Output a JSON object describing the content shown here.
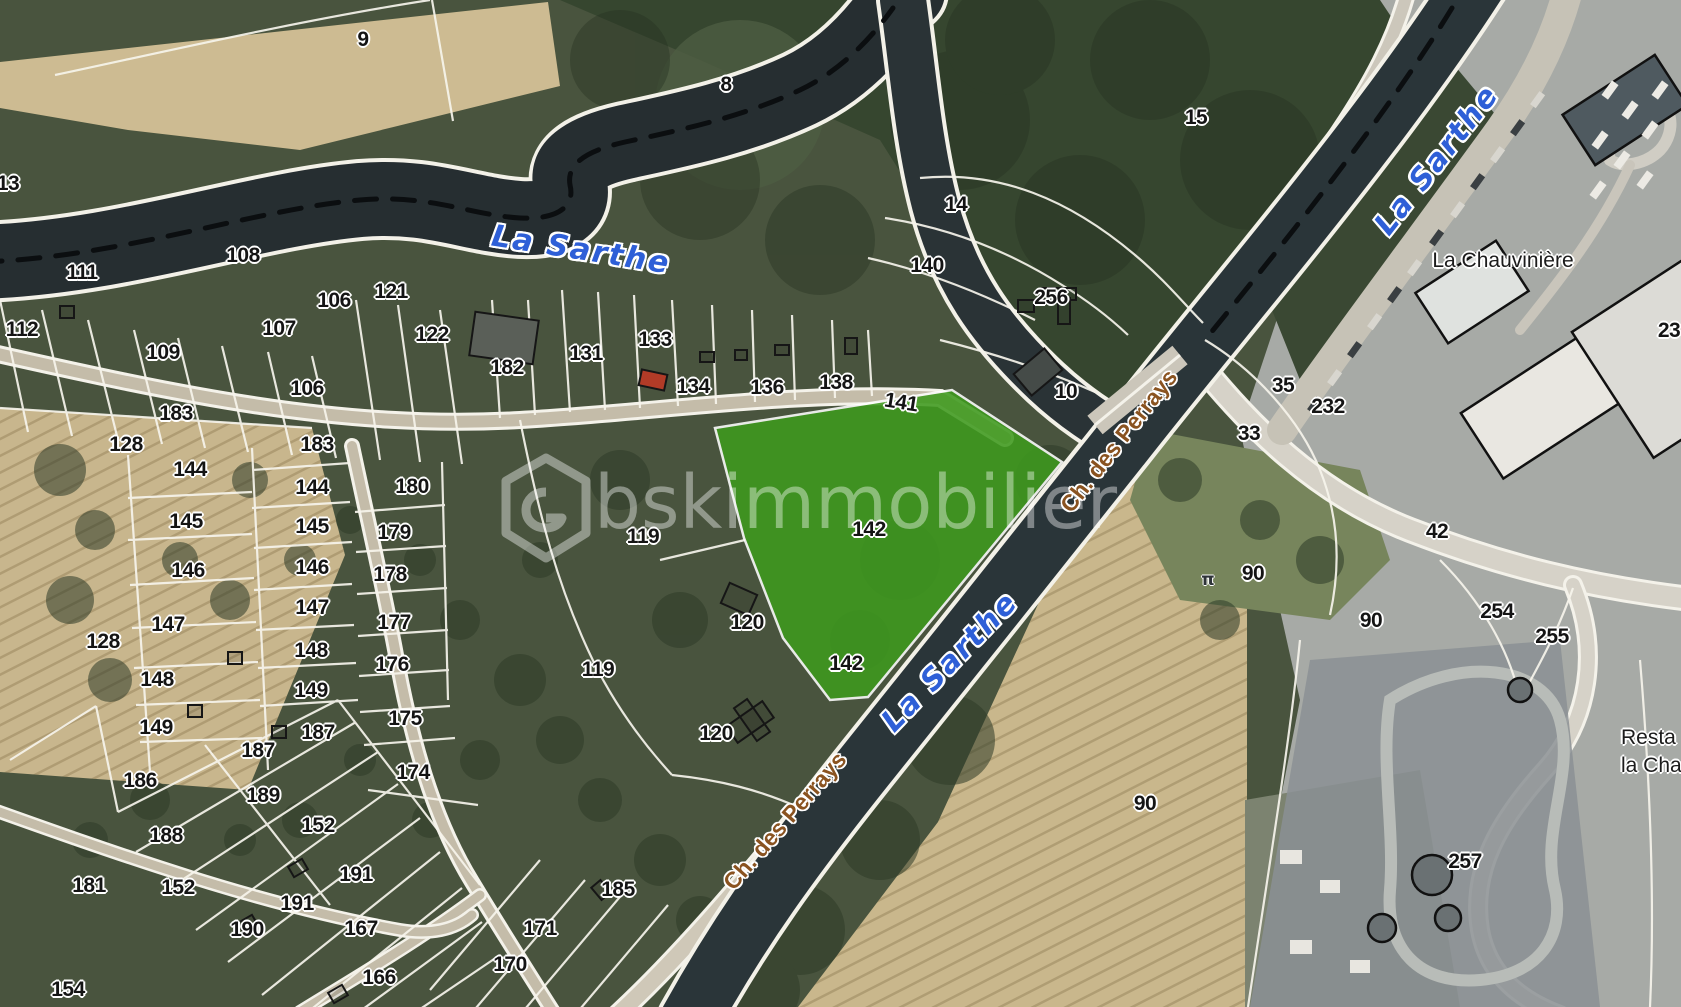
{
  "map": {
    "type": "satellite-cadastral-map",
    "colors": {
      "highlight_green": "#3e9a1e",
      "water_dark": "#262e31",
      "boundary_white": "#f8f6f0",
      "label_black": "#141414",
      "water_label_blue": "#2e5fd7",
      "road_label_brown": "#8a5320",
      "watermark": "rgba(255,255,255,0.40)"
    },
    "watermark": {
      "text": "bskimmobilier",
      "logo": "hexagon-logo"
    },
    "highlighted_parcel": "142",
    "parcel_labels": [
      {
        "t": "9",
        "x": 363,
        "y": 40
      },
      {
        "t": "8",
        "x": 726,
        "y": 85
      },
      {
        "t": "15",
        "x": 1196,
        "y": 118
      },
      {
        "t": "13",
        "x": 8,
        "y": 184
      },
      {
        "t": "14",
        "x": 956,
        "y": 205
      },
      {
        "t": "108",
        "x": 243,
        "y": 256
      },
      {
        "t": "111",
        "x": 82,
        "y": 273
      },
      {
        "t": "140",
        "x": 927,
        "y": 266
      },
      {
        "t": "121",
        "x": 391,
        "y": 292
      },
      {
        "t": "106",
        "x": 334,
        "y": 301
      },
      {
        "t": "256",
        "x": 1051,
        "y": 298
      },
      {
        "t": "107",
        "x": 279,
        "y": 329
      },
      {
        "t": "112",
        "x": 22,
        "y": 330
      },
      {
        "t": "122",
        "x": 432,
        "y": 335
      },
      {
        "t": "133",
        "x": 655,
        "y": 340
      },
      {
        "t": "109",
        "x": 163,
        "y": 353
      },
      {
        "t": "131",
        "x": 586,
        "y": 354
      },
      {
        "t": "182",
        "x": 507,
        "y": 368
      },
      {
        "t": "134",
        "x": 693,
        "y": 387
      },
      {
        "t": "136",
        "x": 767,
        "y": 388
      },
      {
        "t": "138",
        "x": 836,
        "y": 383
      },
      {
        "t": "35",
        "x": 1283,
        "y": 386
      },
      {
        "t": "106",
        "x": 307,
        "y": 389
      },
      {
        "t": "10",
        "x": 1066,
        "y": 392
      },
      {
        "t": "141",
        "x": 901,
        "y": 403,
        "r": 9
      },
      {
        "t": "232",
        "x": 1328,
        "y": 407
      },
      {
        "t": "183",
        "x": 176,
        "y": 414
      },
      {
        "t": "33",
        "x": 1249,
        "y": 434
      },
      {
        "t": "128",
        "x": 126,
        "y": 445
      },
      {
        "t": "183",
        "x": 317,
        "y": 445
      },
      {
        "t": "144",
        "x": 190,
        "y": 470
      },
      {
        "t": "180",
        "x": 412,
        "y": 487
      },
      {
        "t": "144",
        "x": 312,
        "y": 488
      },
      {
        "t": "145",
        "x": 186,
        "y": 522
      },
      {
        "t": "145",
        "x": 312,
        "y": 527
      },
      {
        "t": "142",
        "x": 869,
        "y": 530
      },
      {
        "t": "42",
        "x": 1437,
        "y": 532
      },
      {
        "t": "179",
        "x": 394,
        "y": 533
      },
      {
        "t": "119",
        "x": 643,
        "y": 537
      },
      {
        "t": "146",
        "x": 312,
        "y": 568
      },
      {
        "t": "146",
        "x": 188,
        "y": 571
      },
      {
        "t": "90",
        "x": 1253,
        "y": 574
      },
      {
        "t": "178",
        "x": 390,
        "y": 575
      },
      {
        "t": "147",
        "x": 312,
        "y": 608
      },
      {
        "t": "254",
        "x": 1497,
        "y": 612
      },
      {
        "t": "90",
        "x": 1371,
        "y": 621
      },
      {
        "t": "120",
        "x": 747,
        "y": 623
      },
      {
        "t": "177",
        "x": 394,
        "y": 623
      },
      {
        "t": "147",
        "x": 168,
        "y": 625
      },
      {
        "t": "255",
        "x": 1552,
        "y": 637
      },
      {
        "t": "128",
        "x": 103,
        "y": 642
      },
      {
        "t": "148",
        "x": 311,
        "y": 651
      },
      {
        "t": "142",
        "x": 846,
        "y": 664
      },
      {
        "t": "176",
        "x": 392,
        "y": 665
      },
      {
        "t": "119",
        "x": 598,
        "y": 670
      },
      {
        "t": "148",
        "x": 157,
        "y": 680
      },
      {
        "t": "149",
        "x": 311,
        "y": 691
      },
      {
        "t": "175",
        "x": 405,
        "y": 719
      },
      {
        "t": "149",
        "x": 156,
        "y": 728
      },
      {
        "t": "187",
        "x": 318,
        "y": 733
      },
      {
        "t": "120",
        "x": 716,
        "y": 734
      },
      {
        "t": "187",
        "x": 258,
        "y": 751
      },
      {
        "t": "174",
        "x": 413,
        "y": 773
      },
      {
        "t": "186",
        "x": 140,
        "y": 781
      },
      {
        "t": "189",
        "x": 263,
        "y": 796
      },
      {
        "t": "90",
        "x": 1145,
        "y": 804
      },
      {
        "t": "152",
        "x": 318,
        "y": 826
      },
      {
        "t": "188",
        "x": 166,
        "y": 836
      },
      {
        "t": "257",
        "x": 1465,
        "y": 862
      },
      {
        "t": "191",
        "x": 356,
        "y": 875
      },
      {
        "t": "181",
        "x": 89,
        "y": 886
      },
      {
        "t": "152",
        "x": 178,
        "y": 888
      },
      {
        "t": "185",
        "x": 618,
        "y": 890
      },
      {
        "t": "191",
        "x": 297,
        "y": 904
      },
      {
        "t": "167",
        "x": 361,
        "y": 929
      },
      {
        "t": "190",
        "x": 247,
        "y": 930
      },
      {
        "t": "171",
        "x": 540,
        "y": 929
      },
      {
        "t": "170",
        "x": 510,
        "y": 965
      },
      {
        "t": "166",
        "x": 379,
        "y": 978
      },
      {
        "t": "154",
        "x": 68,
        "y": 990
      },
      {
        "t": "23",
        "x": 1669,
        "y": 331
      }
    ],
    "water_labels": [
      {
        "t": "La Sarthe",
        "x": 581,
        "y": 250,
        "r": 9
      },
      {
        "t": "La Sarthe",
        "x": 1437,
        "y": 160,
        "r": -52
      },
      {
        "t": "La Sarthe",
        "x": 950,
        "y": 662,
        "r": -46
      }
    ],
    "road_labels": [
      {
        "t": "Ch. des Perrays",
        "x": 1119,
        "y": 441,
        "r": -52
      },
      {
        "t": "Ch. des Perrays",
        "x": 785,
        "y": 821,
        "r": -49
      }
    ],
    "place_labels": [
      {
        "t": "La Chauvinière",
        "x": 1503,
        "y": 261
      }
    ],
    "edge_label": {
      "line1": "Resta",
      "line2": "la Cha",
      "x": 1621,
      "y": 724
    },
    "icons": [
      {
        "name": "picnic-table-icon",
        "glyph": "π",
        "x": 1208,
        "y": 580
      }
    ]
  }
}
